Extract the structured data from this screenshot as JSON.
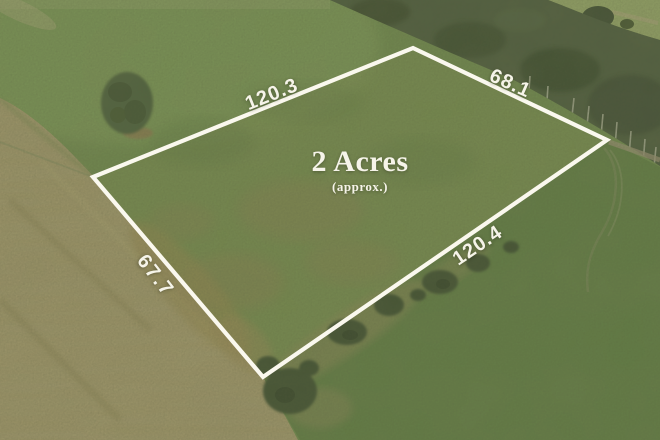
{
  "photo": {
    "kind": "aerial-drone-photo-of-land-parcel",
    "overlay": {
      "area_label": "2 Acres",
      "area_qualifier": "(approx.)",
      "dimensions": {
        "top_edge": "120.3",
        "right_edge": "68.1",
        "bottom_edge": "120.4",
        "left_edge": "67.7"
      }
    },
    "colors": {
      "boundary_line": "#faf8ee",
      "label_text": "#f6f4e9",
      "grass_green": "#6e8b4d",
      "dry_grass": "#a29868",
      "tree_canopy": "#46583a"
    }
  }
}
